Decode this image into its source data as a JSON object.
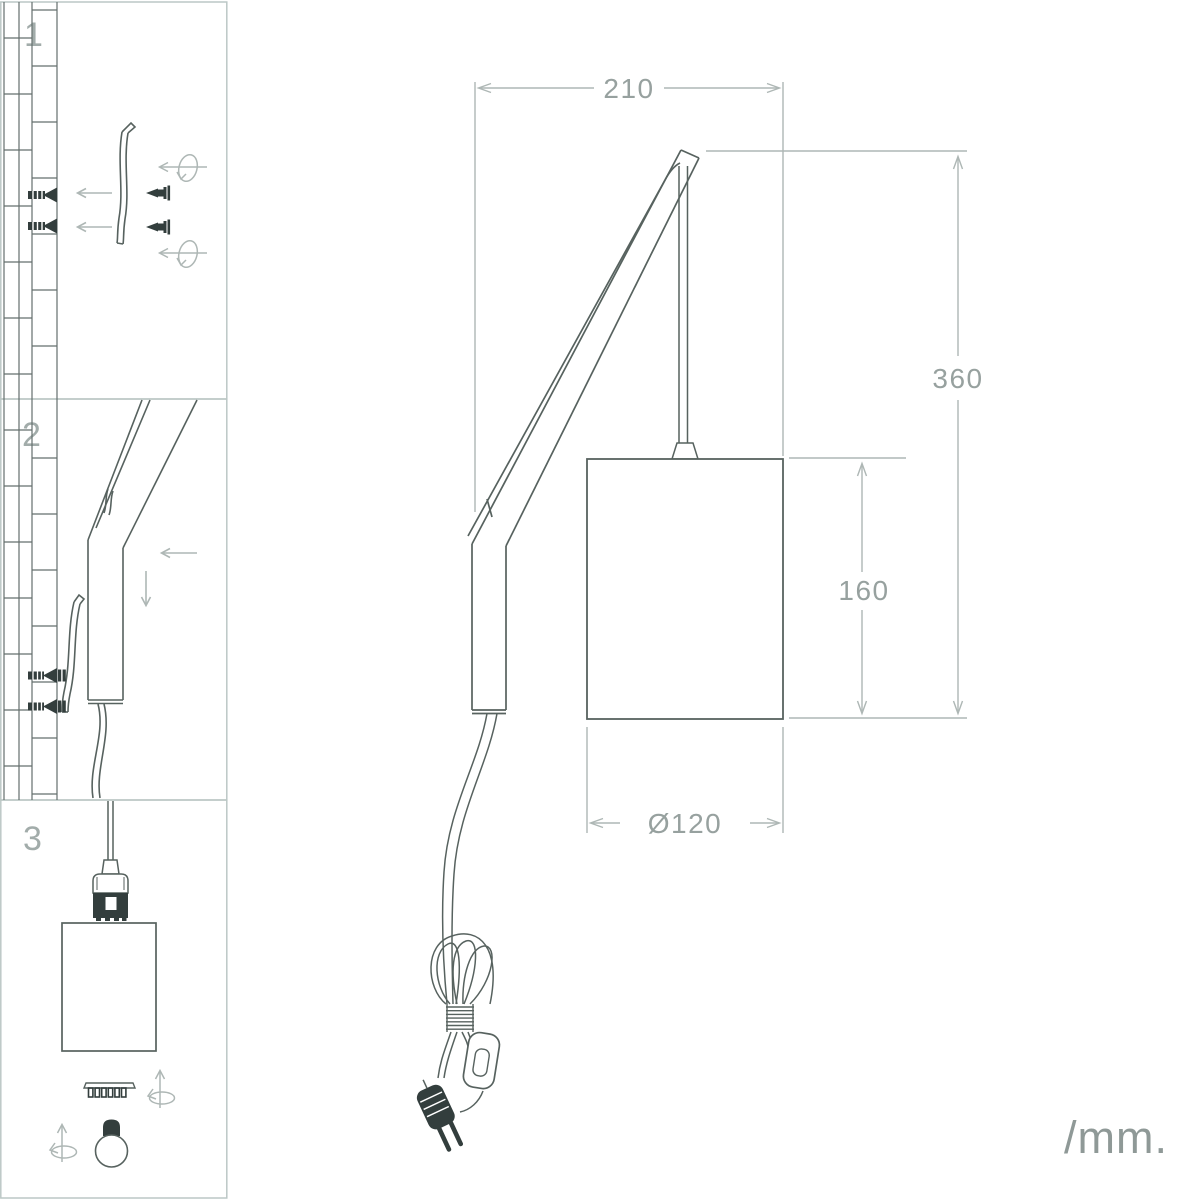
{
  "unit_label": "/mm.",
  "steps": [
    {
      "number": "1"
    },
    {
      "number": "2"
    },
    {
      "number": "3"
    }
  ],
  "dimensions": {
    "total_width": {
      "value": "210"
    },
    "total_height": {
      "value": "360"
    },
    "shade_height": {
      "value": "160"
    },
    "shade_diameter": {
      "value": "Ø120"
    }
  },
  "colors": {
    "drawing_line": "#57625f",
    "dark_fill": "#333e3d",
    "dimension_line": "#aeb7b5",
    "label_text": "#97a19f",
    "panel_border": "#bcc7c5",
    "wall_line": "#646f6d",
    "background": "#ffffff"
  }
}
